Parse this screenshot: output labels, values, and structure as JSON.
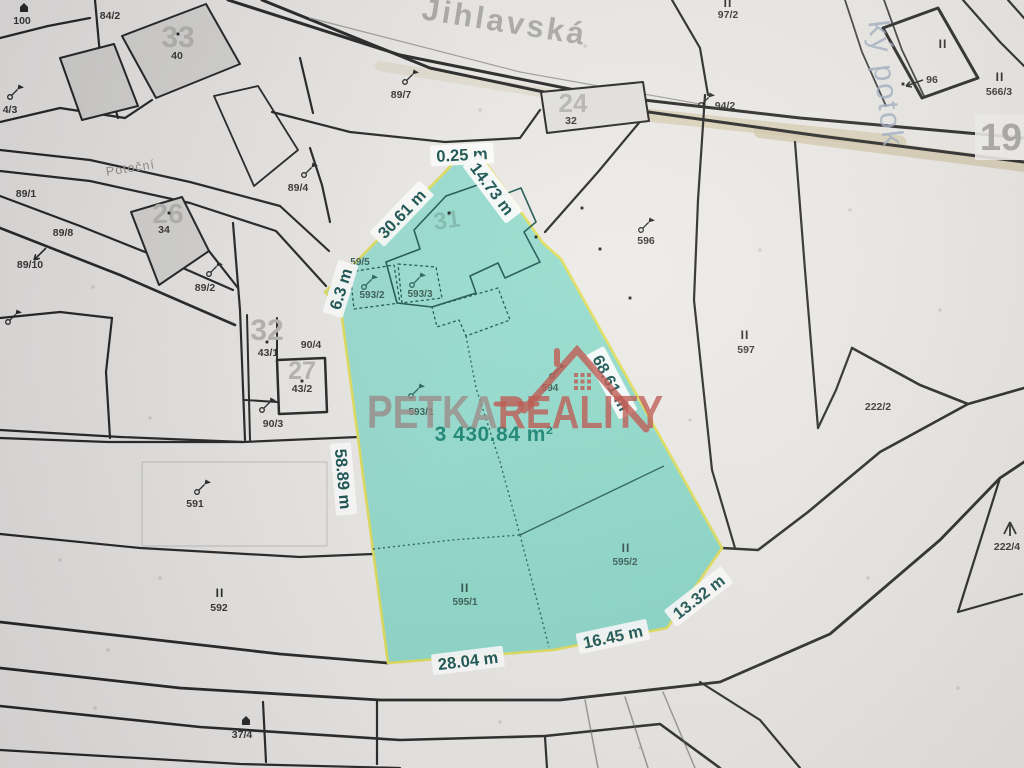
{
  "colors": {
    "background": "#eceae6",
    "boundary_line": "#1b1b1b",
    "highlight_fill": "#84d8c7",
    "highlight_border": "#dfdd52",
    "measurement_text": "#0b4a46",
    "area_text": "#0c7f6c",
    "watermark_gray": "#94817d",
    "watermark_red": "#b9473e",
    "road_stripe": "#d9ceb2",
    "stream_text": "#9aa8bf"
  },
  "streets": [
    {
      "t": "Jihlavská",
      "x": 503,
      "y": 32,
      "r": 9,
      "c": "street-main"
    },
    {
      "t": "Potoční",
      "x": 131,
      "y": 172,
      "r": -9,
      "c": "street-side"
    },
    {
      "t": "ký potok",
      "x": 876,
      "y": 85,
      "r": 83,
      "c": "stream"
    }
  ],
  "watermark": {
    "part1": "PETKA",
    "part2": "REALITY"
  },
  "highlight": {
    "area_label": "3 430.84 m²",
    "area_x": 494,
    "area_y": 441,
    "measurements": [
      {
        "t": "0.25 m",
        "x": 462,
        "y": 155,
        "r": -3
      },
      {
        "t": "14.73 m",
        "x": 492,
        "y": 189,
        "r": 53
      },
      {
        "t": "30.61 m",
        "x": 402,
        "y": 214,
        "r": -46
      },
      {
        "t": "6.3 m",
        "x": 341,
        "y": 289,
        "r": -73
      },
      {
        "t": "58.89 m",
        "x": 343,
        "y": 479,
        "r": 85
      },
      {
        "t": "68.61 m",
        "x": 611,
        "y": 383,
        "r": 62
      },
      {
        "t": "13.32 m",
        "x": 699,
        "y": 597,
        "r": -38
      },
      {
        "t": "16.45 m",
        "x": 613,
        "y": 637,
        "r": -12
      },
      {
        "t": "28.04 m",
        "x": 468,
        "y": 661,
        "r": -7
      }
    ]
  },
  "labels": [
    {
      "t": "100",
      "x": 22,
      "y": 24,
      "c": "pl"
    },
    {
      "t": "84/2",
      "x": 110,
      "y": 19,
      "c": "pl"
    },
    {
      "t": "4/3",
      "x": 10,
      "y": 113,
      "c": "pl"
    },
    {
      "t": "89/1",
      "x": 26,
      "y": 197,
      "c": "pl"
    },
    {
      "t": "89/8",
      "x": 63,
      "y": 236,
      "c": "pl"
    },
    {
      "t": "89/10",
      "x": 30,
      "y": 268,
      "c": "pl"
    },
    {
      "t": "89/2",
      "x": 205,
      "y": 291,
      "c": "pl"
    },
    {
      "t": "89/4",
      "x": 298,
      "y": 191,
      "c": "pl"
    },
    {
      "t": "89/7",
      "x": 401,
      "y": 98,
      "c": "pl"
    },
    {
      "t": "94/2",
      "x": 725,
      "y": 109,
      "c": "pl"
    },
    {
      "t": "II",
      "x": 728,
      "y": 7,
      "c": "ii"
    },
    {
      "t": "97/2",
      "x": 728,
      "y": 18,
      "c": "pl"
    },
    {
      "t": "24",
      "x": 573,
      "y": 112,
      "c": "hn",
      "s": 26
    },
    {
      "t": "32",
      "x": 571,
      "y": 124,
      "c": "pl"
    },
    {
      "t": "33",
      "x": 178,
      "y": 47,
      "c": "hn",
      "s": 30
    },
    {
      "t": "40",
      "x": 177,
      "y": 59,
      "c": "pl"
    },
    {
      "t": "26",
      "x": 168,
      "y": 223,
      "c": "hn",
      "s": 28
    },
    {
      "t": "34",
      "x": 164,
      "y": 233,
      "c": "pl"
    },
    {
      "t": "32",
      "x": 267,
      "y": 340,
      "c": "hn",
      "s": 30
    },
    {
      "t": "43/1",
      "x": 268,
      "y": 356,
      "c": "pl"
    },
    {
      "t": "27",
      "x": 302,
      "y": 379,
      "c": "hn",
      "s": 25
    },
    {
      "t": "43/2",
      "x": 302,
      "y": 392,
      "c": "pl"
    },
    {
      "t": "90/4",
      "x": 311,
      "y": 348,
      "c": "pl"
    },
    {
      "t": "90/3",
      "x": 273,
      "y": 427,
      "c": "pl"
    },
    {
      "t": "596",
      "x": 646,
      "y": 244,
      "c": "pl"
    },
    {
      "t": "II",
      "x": 745,
      "y": 339,
      "c": "ii"
    },
    {
      "t": "597",
      "x": 746,
      "y": 353,
      "c": "pl"
    },
    {
      "t": "591",
      "x": 195,
      "y": 507,
      "c": "pl"
    },
    {
      "t": "II",
      "x": 220,
      "y": 597,
      "c": "ii"
    },
    {
      "t": "592",
      "x": 219,
      "y": 611,
      "c": "pl"
    },
    {
      "t": "II",
      "x": 1000,
      "y": 81,
      "c": "ii"
    },
    {
      "t": "566/3",
      "x": 999,
      "y": 95,
      "c": "pl"
    },
    {
      "t": "96",
      "x": 932,
      "y": 83,
      "c": "pl"
    },
    {
      "t": "II",
      "x": 943,
      "y": 48,
      "c": "ii"
    },
    {
      "t": "222/2",
      "x": 878,
      "y": 410,
      "c": "pl"
    },
    {
      "t": "222/4",
      "x": 1007,
      "y": 550,
      "c": "pl"
    },
    {
      "t": "37/4",
      "x": 242,
      "y": 738,
      "c": "pl"
    },
    {
      "t": "59/5",
      "x": 360,
      "y": 265,
      "c": "tl"
    },
    {
      "t": "593/2",
      "x": 372,
      "y": 298,
      "c": "tl"
    },
    {
      "t": "593/3",
      "x": 420,
      "y": 297,
      "c": "tl"
    },
    {
      "t": "593/1",
      "x": 421,
      "y": 415,
      "c": "tl"
    },
    {
      "t": "594",
      "x": 550,
      "y": 391,
      "c": "tl"
    },
    {
      "t": "II",
      "x": 465,
      "y": 592,
      "c": "ii2"
    },
    {
      "t": "595/1",
      "x": 465,
      "y": 605,
      "c": "tl"
    },
    {
      "t": "II",
      "x": 626,
      "y": 552,
      "c": "ii2"
    },
    {
      "t": "595/2",
      "x": 625,
      "y": 565,
      "c": "tl"
    },
    {
      "t": "31",
      "x": 448,
      "y": 228,
      "c": "ghost",
      "s": 24,
      "r": -8
    },
    {
      "t": "19",
      "x": 1001,
      "y": 150,
      "c": "hn19",
      "s": 38
    }
  ],
  "symbols": [
    {
      "k": "house",
      "x": 24,
      "y": 10
    },
    {
      "k": "flag",
      "x": 405,
      "y": 82
    },
    {
      "k": "flag",
      "x": 304,
      "y": 175
    },
    {
      "k": "flag",
      "x": 209,
      "y": 274
    },
    {
      "k": "flag",
      "x": 10,
      "y": 97
    },
    {
      "k": "flag",
      "x": 701,
      "y": 105
    },
    {
      "k": "flag",
      "x": 641,
      "y": 230
    },
    {
      "k": "flag",
      "x": 197,
      "y": 492
    },
    {
      "k": "flag",
      "x": 262,
      "y": 410
    },
    {
      "k": "flag",
      "x": 8,
      "y": 322
    },
    {
      "k": "flagT",
      "x": 364,
      "y": 287
    },
    {
      "k": "flagT",
      "x": 412,
      "y": 285
    },
    {
      "k": "flagT",
      "x": 411,
      "y": 396
    },
    {
      "k": "flagT",
      "x": 552,
      "y": 376
    },
    {
      "k": "house",
      "x": 246,
      "y": 723
    },
    {
      "k": "tree",
      "x": 1010,
      "y": 526
    }
  ],
  "arrows": [
    {
      "x1": 46,
      "y1": 248,
      "x2": 34,
      "y2": 260
    },
    {
      "x1": 923,
      "y1": 80,
      "x2": 906,
      "y2": 86
    }
  ],
  "survey_dots": [
    [
      582,
      208
    ],
    [
      600,
      249
    ],
    [
      630,
      298
    ],
    [
      903,
      84
    ],
    [
      178,
      34
    ],
    [
      169,
      213
    ],
    [
      267,
      342
    ],
    [
      302,
      381
    ],
    [
      449,
      213
    ],
    [
      536,
      237
    ]
  ],
  "faint_marks": [
    [
      93,
      287
    ],
    [
      150,
      418
    ],
    [
      60,
      560
    ],
    [
      160,
      578
    ],
    [
      108,
      650
    ],
    [
      760,
      250
    ],
    [
      850,
      210
    ],
    [
      940,
      310
    ],
    [
      690,
      420
    ],
    [
      500,
      722
    ],
    [
      640,
      748
    ],
    [
      95,
      708
    ],
    [
      585,
      46
    ],
    [
      480,
      110
    ],
    [
      958,
      688
    ],
    [
      868,
      578
    ]
  ]
}
